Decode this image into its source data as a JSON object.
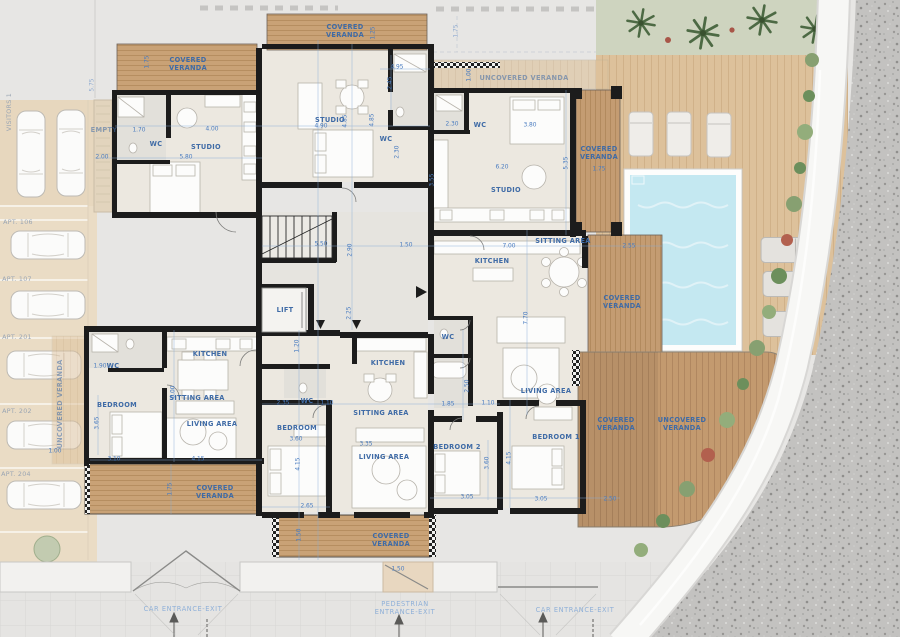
{
  "colors": {
    "site": "#e7e6e4",
    "walls": "#1c1c1c",
    "floor": "#ece8e0",
    "wood_covered": "#c9a276",
    "wood_light": "#ddc19b",
    "wood_deck": "#c39a6f",
    "pool_water": "#c4e8f1",
    "parking": "#eadcc5",
    "gravel": "#c3c2c0",
    "plants": "#87a071",
    "dimension_blue": "#4a7cc0",
    "room_label_blue": "#3f6ba6"
  },
  "labels": {
    "room": [
      {
        "t": "COVERED VERANDA",
        "x": 188,
        "y": 64,
        "w": 50
      },
      {
        "t": "COVERED VERANDA",
        "x": 345,
        "y": 31,
        "w": 50
      },
      {
        "t": "UNCOVERED VERANDA",
        "x": 524,
        "y": 78,
        "f": 1
      },
      {
        "t": "COVERED VERANDA",
        "x": 599,
        "y": 153,
        "w": 50
      },
      {
        "t": "STUDIO",
        "x": 206,
        "y": 147
      },
      {
        "t": "STUDIO",
        "x": 330,
        "y": 120
      },
      {
        "t": "STUDIO",
        "x": 506,
        "y": 190
      },
      {
        "t": "WC",
        "x": 156,
        "y": 144
      },
      {
        "t": "WC",
        "x": 386,
        "y": 139
      },
      {
        "t": "WC",
        "x": 480,
        "y": 125
      },
      {
        "t": "SITTING AREA",
        "x": 563,
        "y": 241
      },
      {
        "t": "KITCHEN",
        "x": 492,
        "y": 261
      },
      {
        "t": "COVERED VERANDA",
        "x": 622,
        "y": 302,
        "w": 50
      },
      {
        "t": "LIVING AREA",
        "x": 546,
        "y": 391
      },
      {
        "t": "WC",
        "x": 448,
        "y": 337
      },
      {
        "t": "KITCHEN",
        "x": 388,
        "y": 363
      },
      {
        "t": "WC",
        "x": 307,
        "y": 401
      },
      {
        "t": "BEDROOM",
        "x": 297,
        "y": 428
      },
      {
        "t": "SITTING AREA",
        "x": 381,
        "y": 413
      },
      {
        "t": "LIVING AREA",
        "x": 384,
        "y": 457
      },
      {
        "t": "COVERED VERANDA",
        "x": 391,
        "y": 540,
        "w": 50
      },
      {
        "t": "KITCHEN",
        "x": 210,
        "y": 354
      },
      {
        "t": "SITTING AREA",
        "x": 197,
        "y": 398
      },
      {
        "t": "LIVING AREA",
        "x": 212,
        "y": 424
      },
      {
        "t": "WC",
        "x": 113,
        "y": 366
      },
      {
        "t": "BEDROOM",
        "x": 117,
        "y": 405
      },
      {
        "t": "COVERED VERANDA",
        "x": 215,
        "y": 492,
        "w": 50
      },
      {
        "t": "UNCOVERED VERANDA",
        "x": 60,
        "y": 404,
        "r": -90,
        "f": 1
      },
      {
        "t": "BEDROOM 2",
        "x": 457,
        "y": 447
      },
      {
        "t": "BEDROOM 1",
        "x": 556,
        "y": 437
      },
      {
        "t": "COVERED VERANDA",
        "x": 616,
        "y": 424,
        "w": 50
      },
      {
        "t": "UNCOVERED VERANDA",
        "x": 682,
        "y": 424,
        "w": 62
      },
      {
        "t": "LIFT",
        "x": 285,
        "y": 310
      },
      {
        "t": "EMPTY",
        "x": 104,
        "y": 130,
        "f": 1
      }
    ],
    "dim": [
      {
        "t": "1.75",
        "x": 148,
        "y": 62,
        "r": -90
      },
      {
        "t": "4.00",
        "x": 212,
        "y": 130
      },
      {
        "t": "1.70",
        "x": 139,
        "y": 131
      },
      {
        "t": "5.80",
        "x": 186,
        "y": 158
      },
      {
        "t": "2.00",
        "x": 102,
        "y": 158
      },
      {
        "t": "5.75",
        "x": 93,
        "y": 85,
        "r": -90,
        "f": 1
      },
      {
        "t": "1.25",
        "x": 374,
        "y": 33,
        "r": -90
      },
      {
        "t": "4.90",
        "x": 321,
        "y": 127
      },
      {
        "t": "4.85",
        "x": 346,
        "y": 121,
        "r": -90
      },
      {
        "t": "4.85",
        "x": 373,
        "y": 120,
        "r": -90
      },
      {
        "t": "4.95",
        "x": 397,
        "y": 68
      },
      {
        "t": "2.45",
        "x": 391,
        "y": 83,
        "r": -90
      },
      {
        "t": "2.30",
        "x": 398,
        "y": 152,
        "r": -90
      },
      {
        "t": "2.30",
        "x": 452,
        "y": 125
      },
      {
        "t": "3.80",
        "x": 530,
        "y": 126
      },
      {
        "t": "6.20",
        "x": 502,
        "y": 168
      },
      {
        "t": "5.35",
        "x": 567,
        "y": 163,
        "r": -90
      },
      {
        "t": "3.55",
        "x": 433,
        "y": 180,
        "r": -90
      },
      {
        "t": "1.00",
        "x": 470,
        "y": 75,
        "r": -90
      },
      {
        "t": "1.75",
        "x": 599,
        "y": 170
      },
      {
        "t": "1.75",
        "x": 457,
        "y": 31,
        "r": -90,
        "f": 1
      },
      {
        "t": "7.00",
        "x": 509,
        "y": 247
      },
      {
        "t": "2.55",
        "x": 629,
        "y": 247
      },
      {
        "t": "7.70",
        "x": 527,
        "y": 318,
        "r": -90
      },
      {
        "t": "5.50",
        "x": 321,
        "y": 245
      },
      {
        "t": "2.90",
        "x": 351,
        "y": 250,
        "r": -90
      },
      {
        "t": "1.50",
        "x": 406,
        "y": 246
      },
      {
        "t": "2.25",
        "x": 350,
        "y": 313,
        "r": -90
      },
      {
        "t": "1.20",
        "x": 298,
        "y": 346,
        "r": -90
      },
      {
        "t": "2.35",
        "x": 283,
        "y": 404
      },
      {
        "t": "1.10",
        "x": 327,
        "y": 404
      },
      {
        "t": "3.60",
        "x": 296,
        "y": 440
      },
      {
        "t": "4.15",
        "x": 299,
        "y": 464,
        "r": -90
      },
      {
        "t": "2.65",
        "x": 307,
        "y": 507
      },
      {
        "t": "3.35",
        "x": 366,
        "y": 445
      },
      {
        "t": "1.50",
        "x": 300,
        "y": 535,
        "r": -90
      },
      {
        "t": "1.85",
        "x": 448,
        "y": 405
      },
      {
        "t": "1.10",
        "x": 488,
        "y": 404
      },
      {
        "t": "2.50",
        "x": 468,
        "y": 386,
        "r": -90
      },
      {
        "t": "3.05",
        "x": 467,
        "y": 498
      },
      {
        "t": "1.90",
        "x": 100,
        "y": 367
      },
      {
        "t": "3.65",
        "x": 98,
        "y": 423,
        "r": -90
      },
      {
        "t": "3.10",
        "x": 114,
        "y": 460
      },
      {
        "t": "6.00",
        "x": 174,
        "y": 392,
        "r": -90
      },
      {
        "t": "4.15",
        "x": 198,
        "y": 460
      },
      {
        "t": "1.00",
        "x": 55,
        "y": 452
      },
      {
        "t": "1.75",
        "x": 171,
        "y": 489,
        "r": -90
      },
      {
        "t": "3.60",
        "x": 488,
        "y": 463,
        "r": -90
      },
      {
        "t": "3.05",
        "x": 541,
        "y": 500
      },
      {
        "t": "4.15",
        "x": 510,
        "y": 458,
        "r": -90
      },
      {
        "t": "2.50",
        "x": 610,
        "y": 500
      },
      {
        "t": "1.50",
        "x": 398,
        "y": 570
      }
    ],
    "site": [
      {
        "t": "VISITORS 1",
        "x": 10,
        "y": 112,
        "r": -90
      },
      {
        "t": "APT. 106",
        "x": 18,
        "y": 223
      },
      {
        "t": "APT. 107",
        "x": 17,
        "y": 280
      },
      {
        "t": "APT. 201",
        "x": 17,
        "y": 338
      },
      {
        "t": "APT. 202",
        "x": 17,
        "y": 412
      },
      {
        "t": "APT. 204",
        "x": 16,
        "y": 475
      }
    ],
    "entrance": [
      {
        "t": "CAR ENTRANCE-EXIT",
        "x": 183,
        "y": 609
      },
      {
        "t": "PEDESTRIAN ENTRANCE-EXIT",
        "x": 405,
        "y": 608,
        "w": 92
      },
      {
        "t": "CAR ENTRANCE-EXIT",
        "x": 575,
        "y": 610
      }
    ]
  }
}
